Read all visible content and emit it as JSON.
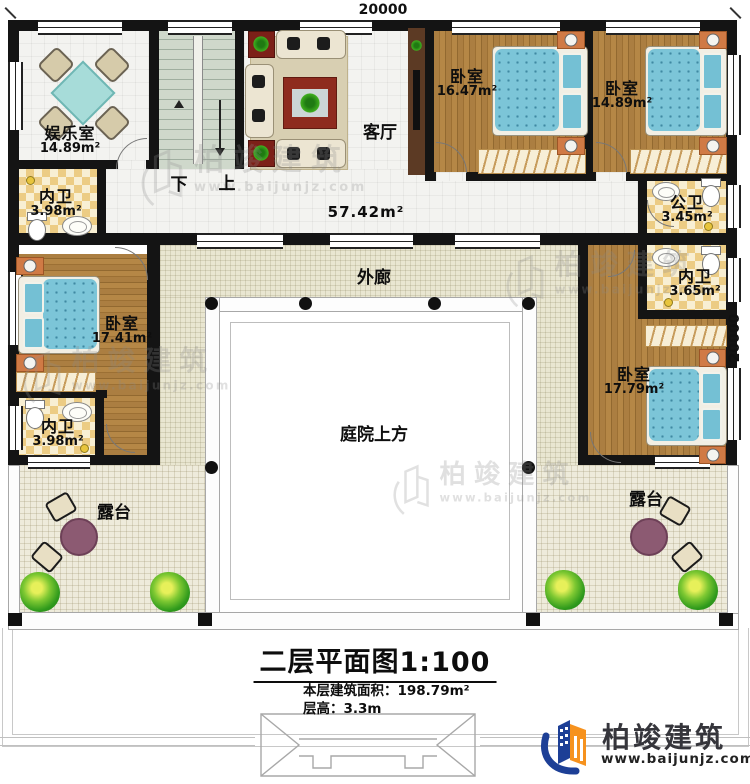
{
  "dimensions": {
    "top": "20000",
    "right": "20000"
  },
  "rooms": {
    "entertainment": {
      "name": "娱乐室",
      "area": "14.89m²"
    },
    "bath_top_left": {
      "name": "内卫",
      "area": "3.98m²"
    },
    "living": {
      "name": "客厅",
      "area": "57.42m²"
    },
    "bedroom_top_1": {
      "name": "卧室",
      "area": "16.47m²"
    },
    "bedroom_top_2": {
      "name": "卧室",
      "area": "14.89m²"
    },
    "public_bath": {
      "name": "公卫",
      "area": "3.45m²"
    },
    "bath_right": {
      "name": "内卫",
      "area": "3.65m²"
    },
    "bedroom_left": {
      "name": "卧室",
      "area": "17.41m²"
    },
    "bath_left": {
      "name": "内卫",
      "area": "3.98m²"
    },
    "bedroom_right": {
      "name": "卧室",
      "area": "17.79m²"
    }
  },
  "stairs": {
    "down": "下",
    "up": "上"
  },
  "areas": {
    "corridor": "外廊",
    "courtyard": "庭院上方",
    "terrace": "露台"
  },
  "title_block": {
    "title": "二层平面图",
    "scale": "1:100",
    "floor_area": "本层建筑面积：198.79m²",
    "floor_height": "层高：3.3m"
  },
  "logo": {
    "brand": "柏竣建筑",
    "url": "www.baijunjz.com"
  },
  "watermark": {
    "brand": "柏竣建筑",
    "url": "www.baijunjz.com"
  },
  "colors": {
    "wall": "#141414",
    "wood": "#a87c42",
    "bed": "#7cc5d8",
    "corridor_floor": "#e9e6d1",
    "logo_blue": "#1d3f96",
    "logo_orange": "#f6921e"
  }
}
